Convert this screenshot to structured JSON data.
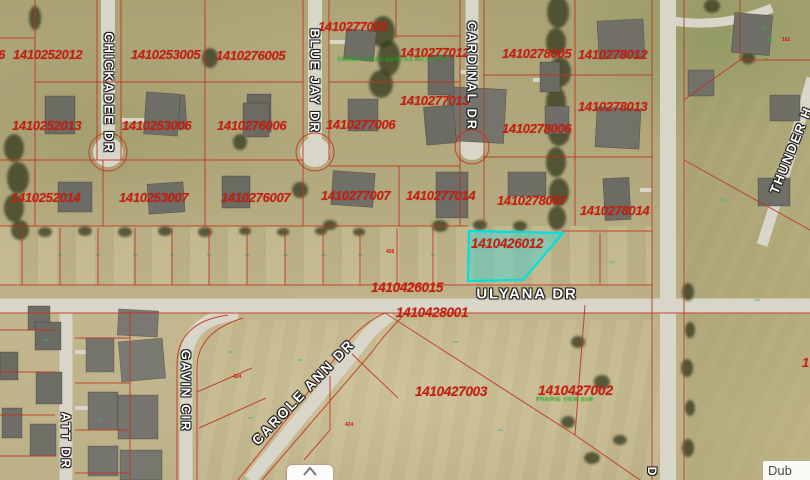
{
  "map": {
    "selected_parcel": {
      "id": "1410426012"
    },
    "colors": {
      "aerial_base": "#b4aa80",
      "parcel_line": "#c0331f",
      "highlight_fill": "rgba(80,210,205,0.5)",
      "highlight_stroke": "#00dfe0",
      "parcel_text": "#c81e0f",
      "street_text": "#ffffff",
      "green_text": "#1fa81f",
      "road": "#d8d5c9"
    },
    "parcel_labels": [
      {
        "text": "1410252012",
        "x": 13,
        "y": 47,
        "size": 13
      },
      {
        "text": "1410253005",
        "x": 131,
        "y": 47,
        "size": 13
      },
      {
        "text": "1410276005",
        "x": 216,
        "y": 48,
        "size": 13
      },
      {
        "text": "1410277005",
        "x": 318,
        "y": 19,
        "size": 13
      },
      {
        "text": "1410277012",
        "x": 400,
        "y": 45,
        "size": 13
      },
      {
        "text": "1410278005",
        "x": 502,
        "y": 46,
        "size": 13
      },
      {
        "text": "1410278012",
        "x": 578,
        "y": 47,
        "size": 13
      },
      {
        "text": "1410252013",
        "x": 12,
        "y": 118,
        "size": 13
      },
      {
        "text": "1410253006",
        "x": 122,
        "y": 118,
        "size": 13
      },
      {
        "text": "1410276006",
        "x": 217,
        "y": 118,
        "size": 13
      },
      {
        "text": "1410277006",
        "x": 326,
        "y": 117,
        "size": 13
      },
      {
        "text": "1410277013",
        "x": 400,
        "y": 93,
        "size": 13
      },
      {
        "text": "1410278006",
        "x": 502,
        "y": 121,
        "size": 13
      },
      {
        "text": "1410278013",
        "x": 578,
        "y": 99,
        "size": 13
      },
      {
        "text": "1410252014",
        "x": 11,
        "y": 190,
        "size": 13
      },
      {
        "text": "1410253007",
        "x": 119,
        "y": 190,
        "size": 13
      },
      {
        "text": "1410276007",
        "x": 221,
        "y": 190,
        "size": 13
      },
      {
        "text": "1410277007",
        "x": 321,
        "y": 188,
        "size": 13
      },
      {
        "text": "1410277014",
        "x": 406,
        "y": 188,
        "size": 13
      },
      {
        "text": "1410278007",
        "x": 497,
        "y": 193,
        "size": 13
      },
      {
        "text": "1410278014",
        "x": 580,
        "y": 203,
        "size": 13
      },
      {
        "text": "1410426012",
        "x": 471,
        "y": 236,
        "size": 13.5
      },
      {
        "text": "1410426015",
        "x": 371,
        "y": 280,
        "size": 13.5
      },
      {
        "text": "1410428001",
        "x": 396,
        "y": 305,
        "size": 13.5
      },
      {
        "text": "1410427003",
        "x": 415,
        "y": 384,
        "size": 13.5
      },
      {
        "text": "1410427002",
        "x": 538,
        "y": 382,
        "size": 14
      },
      {
        "text": "6",
        "x": -2,
        "y": 47,
        "size": 13
      },
      {
        "text": "1",
        "x": 802,
        "y": 355,
        "size": 13
      }
    ],
    "street_labels": [
      {
        "text": "CHICKADEE DR",
        "x": 109,
        "y": 93,
        "rot": 90,
        "size": 13
      },
      {
        "text": "BLUE JAY DR",
        "x": 315,
        "y": 81,
        "rot": 90,
        "size": 13
      },
      {
        "text": "CARDINAL DR",
        "x": 472,
        "y": 76,
        "rot": 90,
        "size": 13
      },
      {
        "text": "ULYANA DR",
        "x": 527,
        "y": 294,
        "rot": 0,
        "size": 15
      },
      {
        "text": "GAVIN CIR",
        "x": 186,
        "y": 391,
        "rot": 90,
        "size": 13
      },
      {
        "text": "CAROLE ANN DR",
        "x": 303,
        "y": 392,
        "rot": -46,
        "size": 14
      },
      {
        "text": "ATT DR",
        "x": 66,
        "y": 441,
        "rot": 90,
        "size": 13
      },
      {
        "text": "THUNDER H",
        "x": 791,
        "y": 150,
        "rot": -68,
        "size": 13
      },
      {
        "text": "D",
        "x": 652,
        "y": 472,
        "rot": 90,
        "size": 12
      }
    ],
    "tiny_labels": [
      {
        "text": "426",
        "x": 386,
        "y": 249
      },
      {
        "text": "424",
        "x": 233,
        "y": 374
      },
      {
        "text": "424",
        "x": 345,
        "y": 422
      },
      {
        "text": "161",
        "x": 782,
        "y": 37
      }
    ],
    "green_annotations": [
      {
        "text": "TIMBER CREEK ESTATES NO 2 LOT 1",
        "x": 337,
        "y": 57
      },
      {
        "text": "PRAIRIE VIEW SUB",
        "x": 536,
        "y": 397
      }
    ],
    "attribution": {
      "text": "Dub"
    }
  }
}
